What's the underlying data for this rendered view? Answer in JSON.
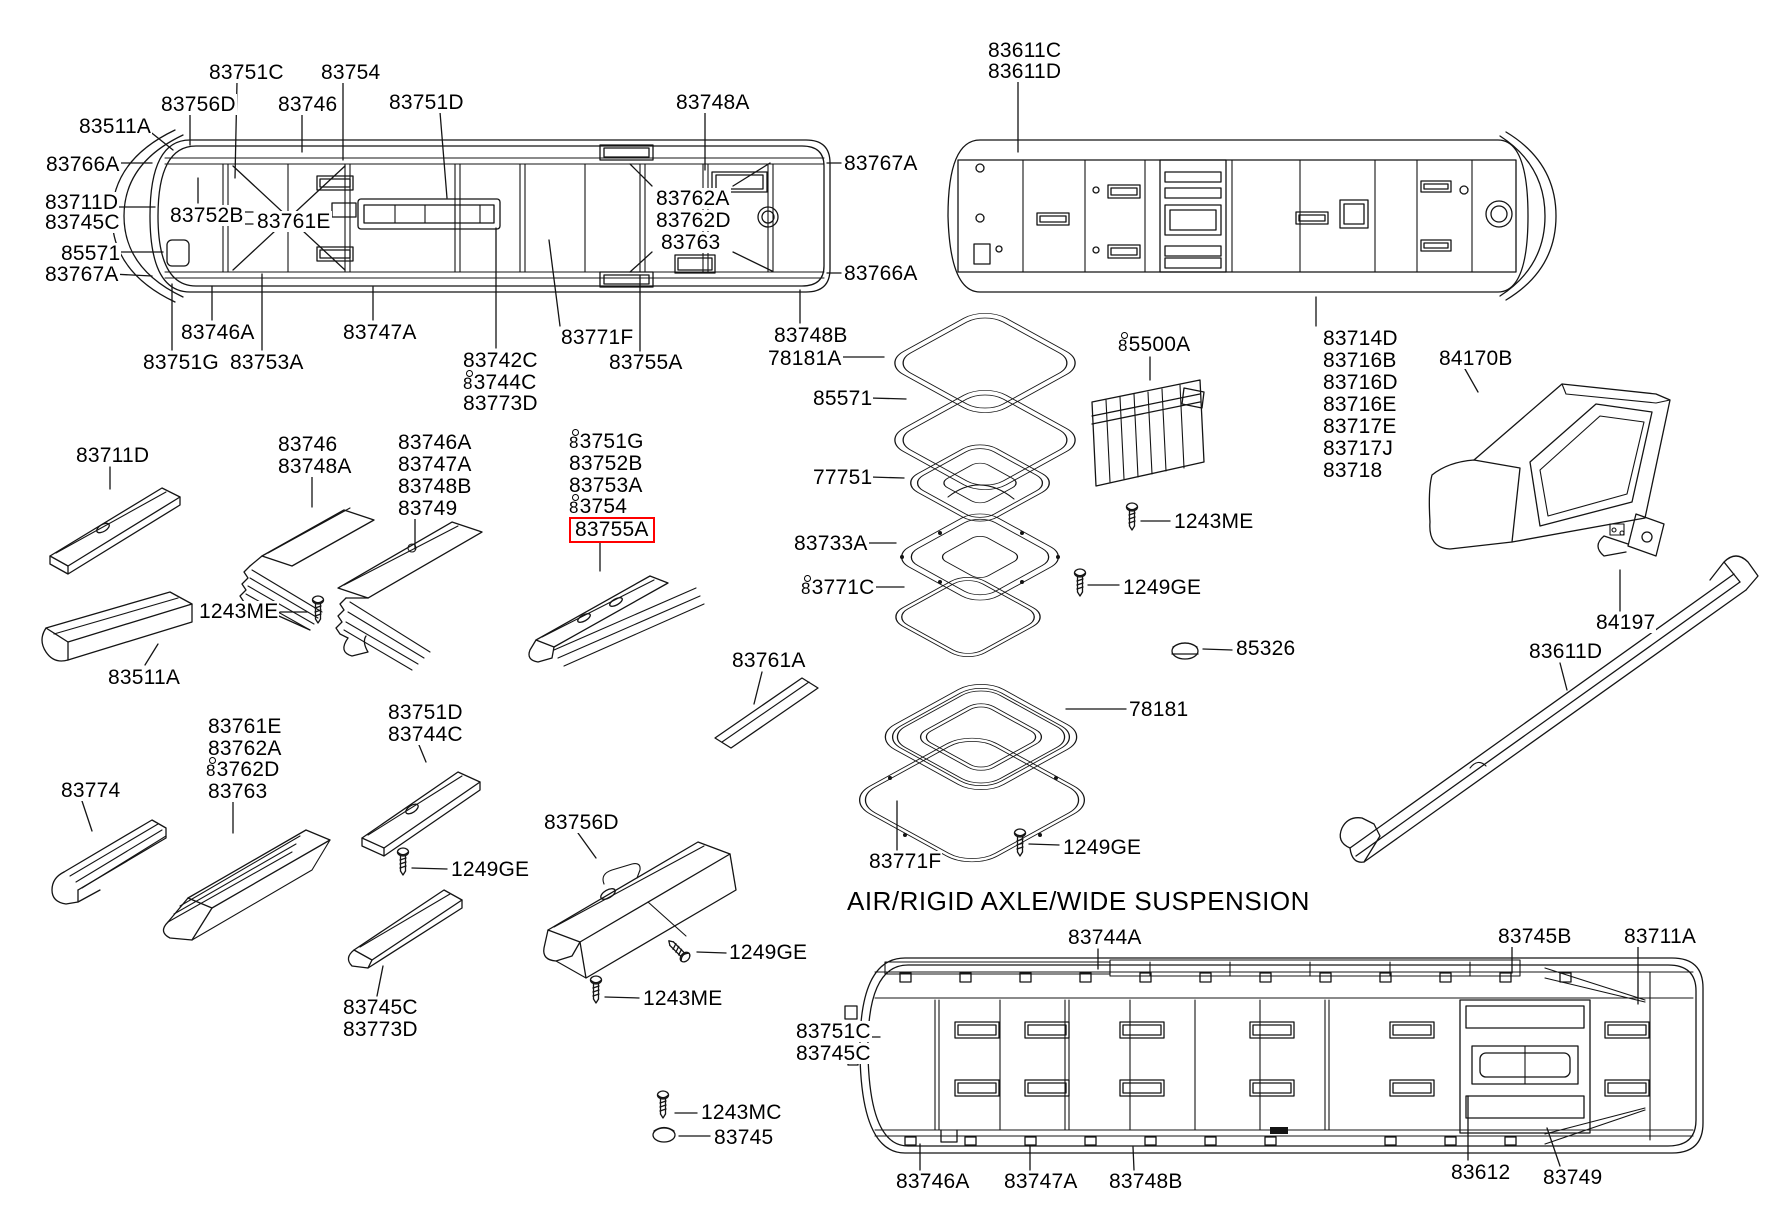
{
  "page": {
    "title": "AIR/RIGID AXLE/WIDE SUSPENSION",
    "highlight_color": "#ff0000",
    "highlighted_part": "83755A",
    "note_symbol": "ring-8-prefix"
  },
  "labels": [
    {
      "t": "83751C",
      "x": 208,
      "y": 62
    },
    {
      "t": "83754",
      "x": 320,
      "y": 62
    },
    {
      "t": "83756D",
      "x": 160,
      "y": 94
    },
    {
      "t": "83746",
      "x": 277,
      "y": 94
    },
    {
      "t": "83751D",
      "x": 388,
      "y": 92
    },
    {
      "t": "83748A",
      "x": 675,
      "y": 92
    },
    {
      "t": "83511A",
      "x": 78,
      "y": 116
    },
    {
      "t": "83766A",
      "x": 45,
      "y": 154
    },
    {
      "t": "83711D",
      "x": 44,
      "y": 192
    },
    {
      "t": "83745C",
      "x": 44,
      "y": 212
    },
    {
      "t": "83752B",
      "x": 169,
      "y": 205
    },
    {
      "t": "83761E",
      "x": 256,
      "y": 211
    },
    {
      "t": "85571",
      "x": 60,
      "y": 243
    },
    {
      "t": "83767A",
      "x": 44,
      "y": 264
    },
    {
      "t": "83767A",
      "x": 843,
      "y": 153
    },
    {
      "t": "83766A",
      "x": 843,
      "y": 263
    },
    {
      "t": "83762A",
      "x": 655,
      "y": 188
    },
    {
      "t": "83762D",
      "x": 655,
      "y": 210
    },
    {
      "t": "83763",
      "x": 660,
      "y": 232
    },
    {
      "t": "83746A",
      "x": 180,
      "y": 322
    },
    {
      "t": "83747A",
      "x": 342,
      "y": 322
    },
    {
      "t": "83771F",
      "x": 560,
      "y": 327
    },
    {
      "t": "83748B",
      "x": 773,
      "y": 325
    },
    {
      "t": "83751G",
      "x": 142,
      "y": 352
    },
    {
      "t": "83753A",
      "x": 229,
      "y": 352
    },
    {
      "t": "83742C",
      "x": 462,
      "y": 350
    },
    {
      "t": "83744C",
      "x": 462,
      "y": 372,
      "r": 1
    },
    {
      "t": "83773D",
      "x": 462,
      "y": 393
    },
    {
      "t": "83755A",
      "x": 608,
      "y": 352
    },
    {
      "t": "83611C",
      "x": 987,
      "y": 40
    },
    {
      "t": "83611D",
      "x": 987,
      "y": 61
    },
    {
      "t": "83714D",
      "x": 1322,
      "y": 328
    },
    {
      "t": "83716B",
      "x": 1322,
      "y": 350
    },
    {
      "t": "83716D",
      "x": 1322,
      "y": 372
    },
    {
      "t": "83716E",
      "x": 1322,
      "y": 394
    },
    {
      "t": "83717E",
      "x": 1322,
      "y": 416
    },
    {
      "t": "83717J",
      "x": 1322,
      "y": 438
    },
    {
      "t": "83718",
      "x": 1322,
      "y": 460
    },
    {
      "t": "84170B",
      "x": 1438,
      "y": 348
    },
    {
      "t": "78181A",
      "x": 767,
      "y": 348
    },
    {
      "t": "85571",
      "x": 812,
      "y": 388
    },
    {
      "t": "77751",
      "x": 812,
      "y": 467
    },
    {
      "t": "83733A",
      "x": 793,
      "y": 533
    },
    {
      "t": "83771C",
      "x": 800,
      "y": 577,
      "r": 1
    },
    {
      "t": "1249GE",
      "x": 1122,
      "y": 577
    },
    {
      "t": "85500A",
      "x": 1117,
      "y": 334,
      "r": 1
    },
    {
      "t": "1243ME",
      "x": 1173,
      "y": 511
    },
    {
      "t": "85326",
      "x": 1235,
      "y": 638
    },
    {
      "t": "78181",
      "x": 1128,
      "y": 699
    },
    {
      "t": "1249GE",
      "x": 1062,
      "y": 837
    },
    {
      "t": "83771F",
      "x": 868,
      "y": 851
    },
    {
      "t": "83761A",
      "x": 731,
      "y": 650
    },
    {
      "t": "83711D",
      "x": 75,
      "y": 445
    },
    {
      "t": "83511A",
      "x": 107,
      "y": 667
    },
    {
      "t": "83746",
      "x": 277,
      "y": 434
    },
    {
      "t": "83748A",
      "x": 277,
      "y": 456
    },
    {
      "t": "1243ME",
      "x": 198,
      "y": 601
    },
    {
      "t": "83746A",
      "x": 397,
      "y": 432
    },
    {
      "t": "83747A",
      "x": 397,
      "y": 454
    },
    {
      "t": "83748B",
      "x": 397,
      "y": 476
    },
    {
      "t": "83749",
      "x": 397,
      "y": 498
    },
    {
      "t": "83751G",
      "x": 568,
      "y": 431,
      "r": 1
    },
    {
      "t": "83752B",
      "x": 568,
      "y": 453
    },
    {
      "t": "83753A",
      "x": 568,
      "y": 475
    },
    {
      "t": "83754",
      "x": 568,
      "y": 496,
      "r": 1
    },
    {
      "t": "83755A",
      "x": 568,
      "y": 517,
      "b": 1
    },
    {
      "t": "83774",
      "x": 60,
      "y": 780
    },
    {
      "t": "83761E",
      "x": 207,
      "y": 716
    },
    {
      "t": "83762A",
      "x": 207,
      "y": 738
    },
    {
      "t": "83762D",
      "x": 205,
      "y": 759,
      "r": 1
    },
    {
      "t": "83763",
      "x": 207,
      "y": 781
    },
    {
      "t": "83751D",
      "x": 387,
      "y": 702
    },
    {
      "t": "83744C",
      "x": 387,
      "y": 724
    },
    {
      "t": "1249GE",
      "x": 450,
      "y": 859
    },
    {
      "t": "83745C",
      "x": 342,
      "y": 997
    },
    {
      "t": "83773D",
      "x": 342,
      "y": 1019
    },
    {
      "t": "83756D",
      "x": 543,
      "y": 812
    },
    {
      "t": "1243ME",
      "x": 642,
      "y": 988
    },
    {
      "t": "1249GE",
      "x": 728,
      "y": 942
    },
    {
      "t": "1243MC",
      "x": 700,
      "y": 1102
    },
    {
      "t": "83745",
      "x": 713,
      "y": 1127
    },
    {
      "t": "83751C",
      "x": 795,
      "y": 1021
    },
    {
      "t": "83745C",
      "x": 795,
      "y": 1043
    },
    {
      "t": "83744A",
      "x": 1067,
      "y": 927
    },
    {
      "t": "83745B",
      "x": 1497,
      "y": 926
    },
    {
      "t": "83711A",
      "x": 1623,
      "y": 926
    },
    {
      "t": "83746A",
      "x": 895,
      "y": 1171
    },
    {
      "t": "83747A",
      "x": 1003,
      "y": 1171
    },
    {
      "t": "83748B",
      "x": 1108,
      "y": 1171
    },
    {
      "t": "83612",
      "x": 1450,
      "y": 1162
    },
    {
      "t": "83749",
      "x": 1542,
      "y": 1167
    },
    {
      "t": "84197",
      "x": 1595,
      "y": 612
    },
    {
      "t": "83611D",
      "x": 1528,
      "y": 641
    }
  ]
}
